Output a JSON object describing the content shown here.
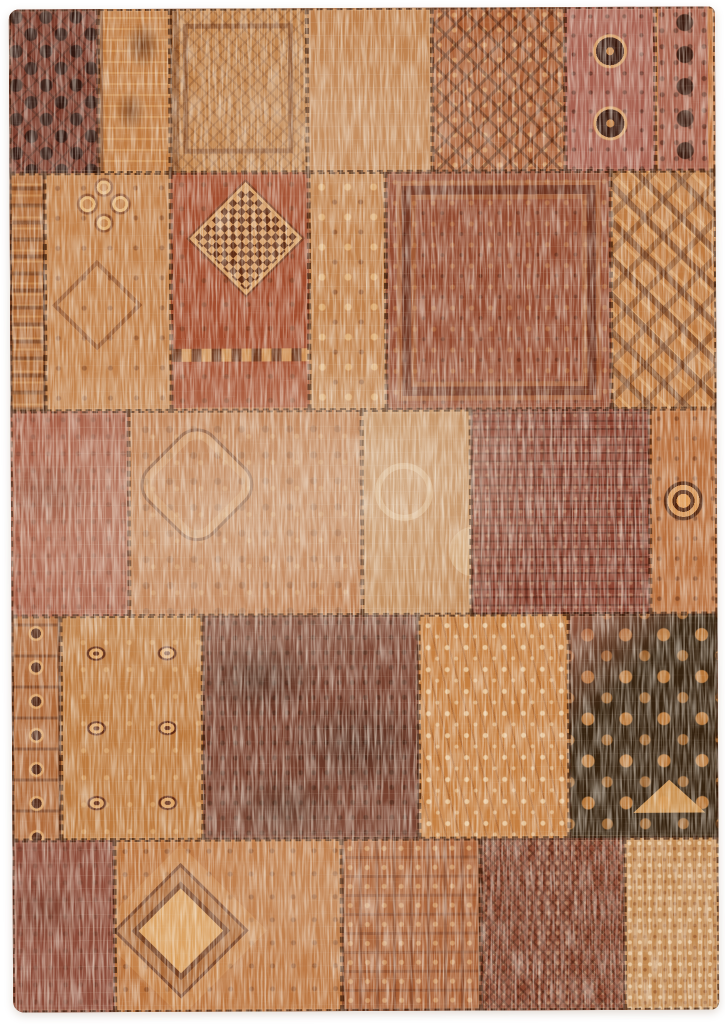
{
  "meta": {
    "description": "Product photograph of a distressed vintage-style patchwork rug in rust, orange, terracotta and dark brown tones, laid flat on a plain white background. The rug is sewn from many rectangular fragments of worn oriental carpets joined with dark stitching.",
    "subject": "patchwork-rug",
    "background": "plain-white"
  },
  "palette": {
    "page_background": "#ffffff",
    "stitch_thread": "#36180a",
    "rug_base": "#8a4a30",
    "wear_cream": "#ead8c0",
    "dark_brown": "#31200f",
    "terracotta": "#a34c2d",
    "orange": "#c07c42",
    "rose": "#a86050"
  },
  "photo": {
    "margins_px": {
      "top": 8,
      "right": 8,
      "bottom": 13,
      "left": 11
    },
    "corner_radius_px": 10,
    "rotation_deg": -0.25
  },
  "rug": {
    "rows": [
      {
        "height": 16.37,
        "patches": [
          {
            "w": 12.55,
            "pattern": "floral-grid",
            "base": "#7b3b2b",
            "accent": "#311710",
            "light": "#c98d5c",
            "wear": 0.22
          },
          {
            "w": 10.3,
            "pattern": "vine",
            "base": "#bf7a40",
            "accent": "#5f2c18",
            "light": "#e6bd8a",
            "wear": 0.28
          },
          {
            "w": 19.32,
            "pattern": "frame",
            "base": "#c08148",
            "accent": "#643016",
            "light": "#e8c694",
            "wear": 0.34
          },
          {
            "w": 17.77,
            "pattern": "plain",
            "base": "#bd7c46",
            "accent": "#8a4526",
            "light": "#ecd0a4",
            "wear": 0.5
          },
          {
            "w": 18.76,
            "pattern": "lattice",
            "base": "#a95c32",
            "accent": "#4a200f",
            "light": "#e3b27b",
            "wear": 0.3
          },
          {
            "w": 12.83,
            "pattern": "guls-rose",
            "base": "#a86050",
            "accent": "#38180e",
            "light": "#d8a06a",
            "wear": 0.26
          },
          {
            "w": 8.47,
            "pattern": "florets",
            "base": "#a85f4a",
            "accent": "#3b1b10",
            "light": "#e2aa6e",
            "wear": 0.3
          }
        ]
      },
      {
        "height": 23.71,
        "patches": [
          {
            "w": 4.94,
            "pattern": "strip",
            "base": "#b06a36",
            "accent": "#542612",
            "light": "#e2a868",
            "wear": 0.3
          },
          {
            "w": 17.91,
            "pattern": "curls",
            "base": "#c28049",
            "accent": "#6d3318",
            "light": "#e6b476",
            "wear": 0.34
          },
          {
            "w": 19.46,
            "pattern": "checker",
            "base": "#a34c2d",
            "accent": "#542810",
            "light": "#dba468",
            "wear": 0.3
          },
          {
            "w": 11.0,
            "pattern": "clover",
            "base": "#c0804a",
            "accent": "#602c14",
            "light": "#ebbe82",
            "wear": 0.46
          },
          {
            "w": 31.88,
            "pattern": "herati",
            "base": "#93492f",
            "accent": "#4d1f12",
            "light": "#d69658",
            "wear": 0.4
          },
          {
            "w": 14.81,
            "pattern": "hooks",
            "base": "#bf7a40",
            "accent": "#562812",
            "light": "#e8b67a",
            "wear": 0.32
          }
        ]
      },
      {
        "height": 20.44,
        "patches": [
          {
            "w": 16.78,
            "pattern": "worn",
            "base": "#a2543c",
            "accent": "#461e10",
            "light": "#e0b088",
            "wear": 0.5
          },
          {
            "w": 32.87,
            "pattern": "octagon",
            "base": "#b76f3e",
            "accent": "#612e14",
            "light": "#e6b880",
            "wear": 0.42
          },
          {
            "w": 15.51,
            "pattern": "wreaths",
            "base": "#bf8551",
            "accent": "#6b3418",
            "light": "#ecd2a6",
            "wear": 0.5
          },
          {
            "w": 25.39,
            "pattern": "dense",
            "base": "#8b4230",
            "accent": "#3a180e",
            "light": "#e4ba8e",
            "wear": 0.46
          },
          {
            "w": 9.45,
            "pattern": "guls-one",
            "base": "#b96f3c",
            "accent": "#54260e",
            "light": "#e09a52",
            "wear": 0.3
          }
        ]
      },
      {
        "height": 22.32,
        "patches": [
          {
            "w": 6.91,
            "pattern": "star-strip",
            "base": "#b06a3a",
            "accent": "#4f2412",
            "light": "#dea05f",
            "wear": 0.3
          },
          {
            "w": 20.17,
            "pattern": "guls-col",
            "base": "#bd7a3e",
            "accent": "#5d2711",
            "light": "#dc9f5c",
            "wear": 0.3
          },
          {
            "w": 30.61,
            "pattern": "mottled",
            "base": "#77402e",
            "accent": "#2c180e",
            "light": "#caa57e",
            "wear": 0.38
          },
          {
            "w": 21.15,
            "pattern": "sprigs",
            "base": "#c67f40",
            "accent": "#6e3418",
            "light": "#f3dab2",
            "wear": 0.4
          },
          {
            "w": 21.16,
            "pattern": "cross-dark",
            "base": "#35220f",
            "accent": "#17100a",
            "light": "#d49a55",
            "wear": 0.26
          }
        ]
      },
      {
        "height": 17.16,
        "patches": [
          {
            "w": 14.39,
            "pattern": "worn",
            "base": "#8c4a38",
            "accent": "#3c1c10",
            "light": "#d2a074",
            "wear": 0.46
          },
          {
            "w": 32.15,
            "pattern": "diamond",
            "base": "#bb733c",
            "accent": "#5f2c14",
            "light": "#dca25f",
            "wear": 0.3
          },
          {
            "w": 19.75,
            "pattern": "geo",
            "base": "#ab6136",
            "accent": "#5e2b18",
            "light": "#ebbe84",
            "wear": 0.36
          },
          {
            "w": 20.45,
            "pattern": "tracery",
            "base": "#8a452e",
            "accent": "#3a1a0e",
            "light": "#e6ba8a",
            "wear": 0.3
          },
          {
            "w": 13.26,
            "pattern": "fine-floral",
            "base": "#c28a52",
            "accent": "#7e3f1f",
            "light": "#f4dcb8",
            "wear": 0.3
          }
        ]
      }
    ]
  }
}
